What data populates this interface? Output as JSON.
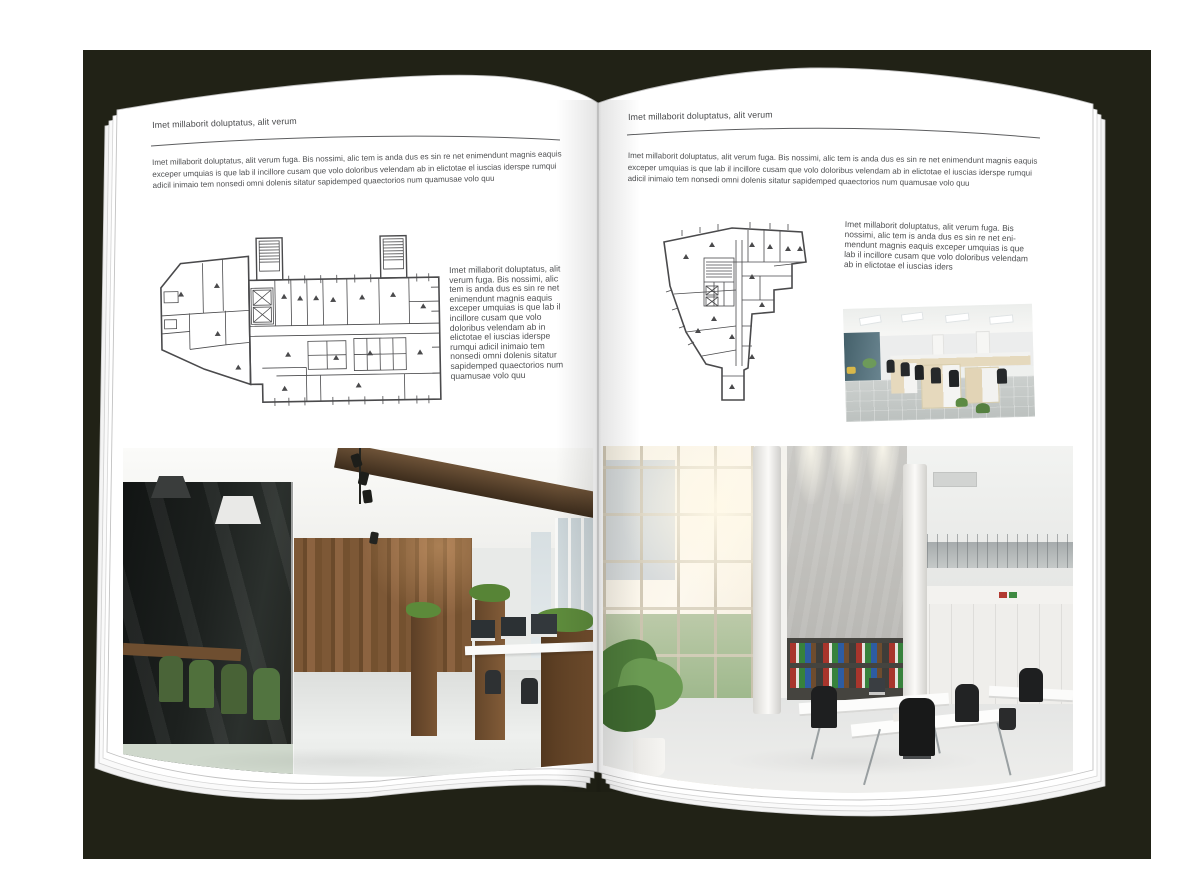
{
  "colors": {
    "backdrop": "#212216",
    "paper": "#ffffff",
    "text": "#4f5052",
    "rule": "#5d5e60"
  },
  "pages": {
    "left": {
      "header": "Imet millaborit doluptatus, alit verum",
      "intro": "Imet millaborit doluptatus, alit verum fuga. Bis nossimi, alic tem is anda dus es sin re net enimendunt magnis eaquis exceper umquias is que lab il incillore cusam que volo doloribus velendam ab in elictotae el iuscias iderspe rumqui adicil inimaio tem nonsedi omni dolenis sitatur sapidemped quaectorios num quamusae volo quu",
      "side_text": "Imet millaborit doluptatus, alit verum fuga. Bis nossimi, alic tem is anda dus es sin re net enimendunt magnis eaquis exceper umquias is que lab il incillore cusam que volo doloribus velendam ab in elictotae el iuscias iderspe rumqui adicil inimaio tem nonsedi omni dolenis sitatur sapidemped quaectorios num quamusae volo quu",
      "figures": {
        "floor_plan": "architectural-floor-plan-wide-block",
        "photo": "loft-office-interior-wood-glass-meeting-room"
      }
    },
    "right": {
      "header": "Imet millaborit doluptatus, alit verum",
      "intro": "Imet millaborit doluptatus, alit verum fuga. Bis nossimi, alic tem is anda dus es sin re net enimendunt magnis eaquis exceper umquias is que lab il incillore cusam que volo doloribus velendam ab in elictotae el iuscias iderspe rumqui adicil inimaio tem nonsedi omni dolenis sitatur sapidemped quaectorios num quamusae volo quu",
      "side_text": "Imet millaborit doluptatus, alit verum fuga. Bis nossimi, alic tem is anda dus es sin re net eni-mendunt magnis eaquis exceper umquias is que lab il incillore cusam que volo doloribus velendam ab in elictotae el iuscias iders",
      "figures": {
        "floor_plan": "architectural-floor-plan-tower-block",
        "photo_small": "open-plan-office-desk-rows",
        "photo_large": "double-height-white-office-atrium"
      }
    }
  }
}
